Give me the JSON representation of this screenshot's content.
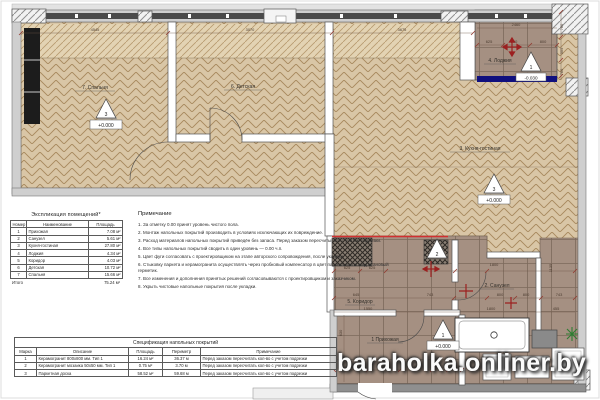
{
  "watermark": "baraholka.onliner.by",
  "explication": {
    "title": "Экспликация помещений*",
    "headers": [
      "Номер",
      "Наименование",
      "Площадь"
    ],
    "rows": [
      [
        "1",
        "Прихожая",
        "7.08 м²"
      ],
      [
        "2",
        "Санузел",
        "5.61 м²"
      ],
      [
        "3",
        "Кухня-гостиная",
        "27.80 м²"
      ],
      [
        "4",
        "Лоджия",
        "4.34 м²"
      ],
      [
        "5",
        "Коридор",
        "4.03 м²"
      ],
      [
        "6",
        "Детская",
        "10.72 м²"
      ],
      [
        "7",
        "Спальня",
        "15.66 м²"
      ]
    ],
    "total_label": "Итого",
    "total_value": "75.24 м²"
  },
  "notes": {
    "title": "Примечание",
    "items": [
      "1. За отметку 0.00 принят уровень чистого пола.",
      "2. Монтаж напольных покрытий производить в условиях исключающих их повреждение.",
      "3. Расход материалов напольных покрытий приведён без запаса. Перед заказом пересчитывать с учетом подрезки.",
      "4. Все типы напольных покрытий сводить в один уровень — 0.00 ч.п.",
      "5. Цвет фуги согласовать с проектировщиком на этапе авторского сопровождения, после укладки.",
      "6. Стыковку паркета и керамогранита осуществлять через пробковый компенсатор в цвет паркета или полиуретановый герметик.",
      "7. Все изменения и дополнения принятых решений согласовываются с проектировщиком и заказчиком.",
      "8. Укрыть чистовые напольные покрытия после укладки."
    ]
  },
  "spec": {
    "title": "Спецификация напольных покрытий",
    "headers": [
      "Марка",
      "Описание",
      "Площадь",
      "Периметр",
      "Примечание"
    ],
    "rows": [
      [
        "1",
        "Керамогранит 800х800 мм. Тип 1",
        "16.24 м²",
        "36.37 м",
        "Перед заказом пересчитать кол-во с учетом подрезки"
      ],
      [
        "2",
        "Керамогранит мозаика 50х50 мм. Тип 1",
        "0.75 м²",
        "3.70 м",
        "Перед заказом пересчитать кол-во с учетом подрезки"
      ],
      [
        "3",
        "Паркетная доска",
        "58.52 м²",
        "59.68 м",
        "Перед заказом пересчитать кол-во с учетом подрезки"
      ]
    ]
  },
  "plan": {
    "room_labels": {
      "r1": "1 Прихожая",
      "r2": "2. Санузел",
      "r3": "3. Кухня-гостиная",
      "r4": "4. Лоджия",
      "r5": "5. Коридор",
      "r6": "6. Детская",
      "r7": "7. Спальня"
    },
    "levels": {
      "main": "+0.000",
      "balcony": "-0.030"
    },
    "marks": {
      "tile": "1",
      "mosaic": "2",
      "parquet": "3"
    },
    "dims": [
      "4545",
      "3070",
      "3675",
      "2460",
      "625",
      "800",
      "800",
      "760",
      "305",
      "760",
      "625",
      "625",
      "1800",
      "1135",
      "645",
      "743",
      "800",
      "800",
      "743",
      "1550",
      "1800",
      "455",
      "800",
      "800",
      "800",
      "315",
      "115",
      "630",
      "570"
    ]
  },
  "colors": {
    "parquet": "#d9c6a6",
    "tile": "#a59082",
    "threshold": "#10107e",
    "marker_red": "#9c2020",
    "plant_green": "#2e7d32"
  }
}
